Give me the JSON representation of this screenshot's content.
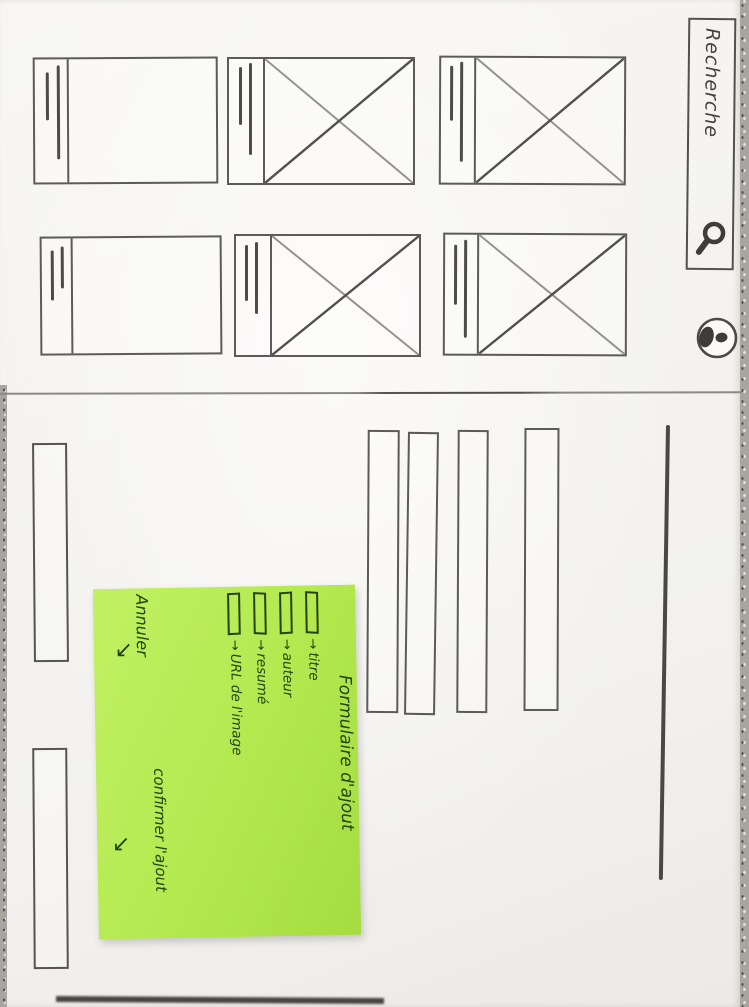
{
  "search": {
    "label": "Recherche",
    "icon": "magnifier-icon"
  },
  "avatar": {
    "icon": "panda-avatar-icon"
  },
  "sticky_note": {
    "title": "Formulaire d'ajout",
    "fields": [
      {
        "arrow": "→",
        "label": "titre"
      },
      {
        "arrow": "→",
        "label": "auteur"
      },
      {
        "arrow": "→",
        "label": "resumé"
      },
      {
        "arrow": "→",
        "label": "URL de l'image"
      }
    ],
    "cancel_label": "Annuler",
    "cancel_arrow": "↘",
    "confirm_label": "confirmer l'ajout",
    "confirm_arrow": "↘"
  },
  "colors": {
    "note": "#b3e94f",
    "ink": "#26430e",
    "pencil": "#5d5b58",
    "paper": "#f5f4f1",
    "table": "#a8a5a1"
  }
}
